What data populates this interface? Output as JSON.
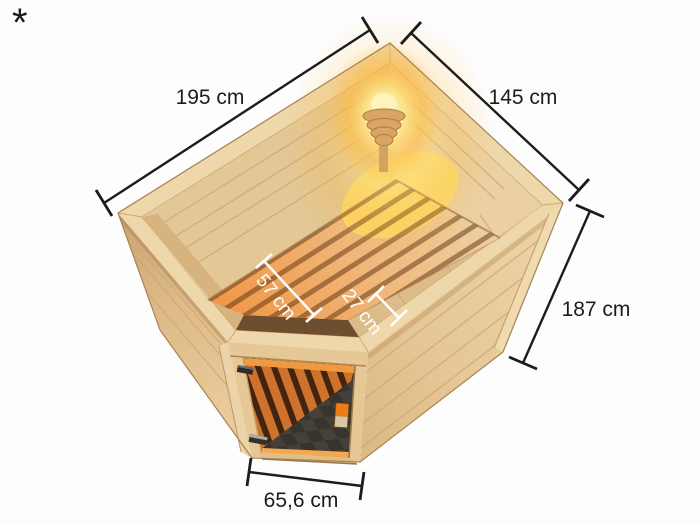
{
  "figure": {
    "description": "Isometric top view of a corner sauna with bronze glass door, slatted interior benches, checkered floor and glowing corner lamp, annotated with external and internal dimensions",
    "footnote_marker": "*"
  },
  "dimensions": {
    "width": "195 cm",
    "depth": "145 cm",
    "height": "187 cm",
    "door_width": "65,6 cm",
    "bench_depth": "57 cm",
    "bench_step_depth": "27 cm"
  },
  "colors": {
    "background": "#fdfdfd",
    "wood_rim": "#eed7aa",
    "wood_mid": "#e2c08c",
    "wood_dark": "#c9a472",
    "bench_orange": "#f0994a",
    "lamp_glow": "#ffcf4f",
    "glass_dark": "#312821",
    "floor_checker_dark": "#37332d",
    "floor_checker_light": "#45403a",
    "orange_box": "#ec7d16",
    "dimension_line": "#1c1c1c",
    "interior_dimension": "#ffffff"
  }
}
